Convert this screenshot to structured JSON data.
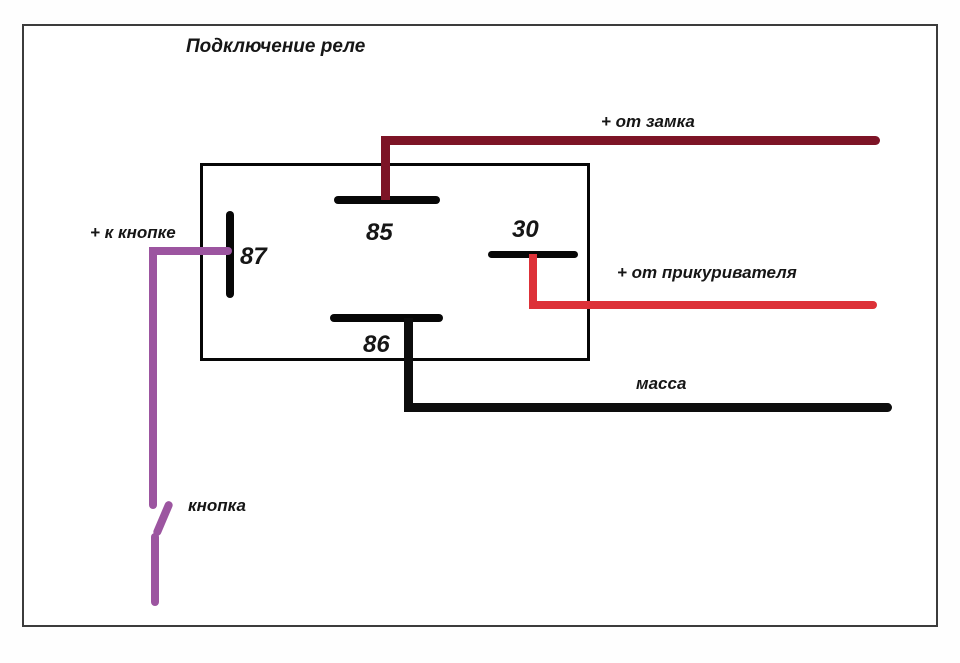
{
  "title": "Подключение реле",
  "relay": {
    "terminals": {
      "t85": "85",
      "t30": "30",
      "t86": "86",
      "t87": "87"
    }
  },
  "wires": {
    "lock": {
      "label": "+ от замка"
    },
    "lighter": {
      "label": "+ от прикуривателя"
    },
    "ground": {
      "label": "масса"
    },
    "button": {
      "label": "+ к кнопке"
    },
    "button_switch": {
      "label": "кнопка"
    }
  },
  "colors": {
    "wire_lock": "#7d1426",
    "wire_lighter": "#dd3138",
    "wire_ground": "#0d0d0d",
    "wire_button": "#9c55a0",
    "terminal_bar": "#070707"
  }
}
